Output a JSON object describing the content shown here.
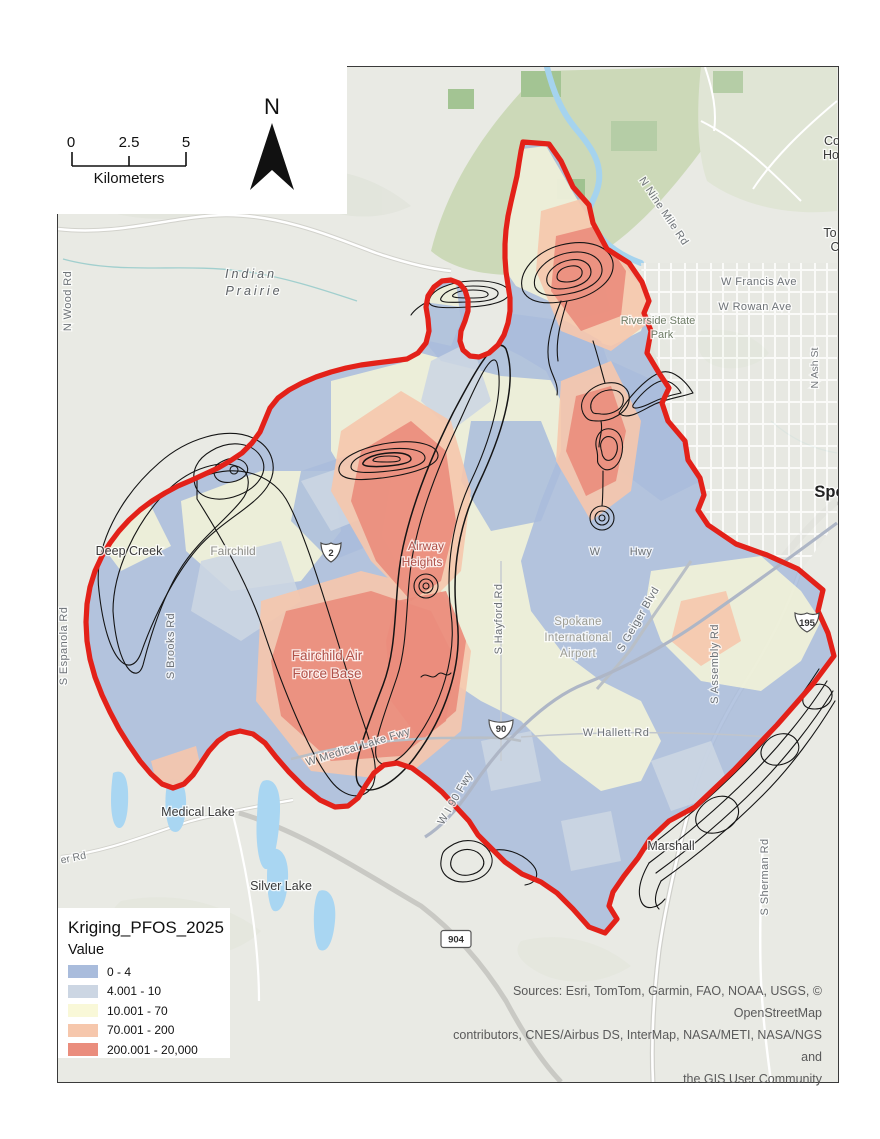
{
  "map": {
    "legend": {
      "title": "Kriging_PFOS_2025",
      "field_label": "Value",
      "items": [
        {
          "label": "0 - 4",
          "color": "#a9bcdc"
        },
        {
          "label": "4.001 - 10",
          "color": "#ccd6e3"
        },
        {
          "label": "10.001 - 70",
          "color": "#f9f8d8"
        },
        {
          "label": "70.001 - 200",
          "color": "#f6c7ac"
        },
        {
          "label": "200.001 - 20,000",
          "color": "#ea8d7d"
        }
      ]
    },
    "scalebar": {
      "ticks": [
        "0",
        "2.5",
        "5"
      ],
      "unit": "Kilometers"
    },
    "north_arrow": {
      "label": "N"
    },
    "attribution": {
      "line1": "Sources: Esri, TomTom, Garmin, FAO, NOAA, USGS, © OpenStreetMap",
      "line2": "contributors, CNES/Airbus DS, InterMap, NASA/METI, NASA/NGS and",
      "line3": "the GIS User Community"
    },
    "colors": {
      "boundary": "#e32119",
      "class1": "#a9bcdc",
      "class2": "#ccd6e3",
      "class3": "#f9f8d8",
      "class4": "#f6c7ac",
      "class5": "#ea8d7d"
    },
    "shields": [
      {
        "name": "us-2",
        "number": "2"
      },
      {
        "name": "i-90",
        "number": "90"
      },
      {
        "name": "us-195",
        "number": "195"
      },
      {
        "name": "sr-904",
        "number": "904"
      }
    ],
    "labels": [
      {
        "name": "label-indian-prairie-1",
        "text": "Indian",
        "x": 250,
        "y": 277,
        "rot": 0,
        "cls": "prairie"
      },
      {
        "name": "label-indian-prairie-2",
        "text": "Prairie",
        "x": 253,
        "y": 294,
        "rot": 0,
        "cls": "prairie"
      },
      {
        "name": "label-n-wood-rd",
        "text": "N Wood Rd",
        "x": 70,
        "y": 300,
        "rot": -90,
        "cls": "road"
      },
      {
        "name": "label-n-nine-mile-rd",
        "text": "N Nine Mile Rd",
        "x": 660,
        "y": 212,
        "rot": 56,
        "cls": "road"
      },
      {
        "name": "label-co",
        "text": "Co",
        "x": 831,
        "y": 144,
        "rot": 0,
        "cls": "town"
      },
      {
        "name": "label-ho",
        "text": "Ho",
        "x": 830,
        "y": 158,
        "rot": 0,
        "cls": "town"
      },
      {
        "name": "label-to",
        "text": "To",
        "x": 829,
        "y": 236,
        "rot": 0,
        "cls": "town"
      },
      {
        "name": "label-c",
        "text": "C",
        "x": 834,
        "y": 250,
        "rot": 0,
        "cls": "town"
      },
      {
        "name": "label-w-francis-ave",
        "text": "W Francis Ave",
        "x": 758,
        "y": 284,
        "rot": 0,
        "cls": "road"
      },
      {
        "name": "label-w-rowan-ave",
        "text": "W Rowan Ave",
        "x": 754,
        "y": 309,
        "rot": 0,
        "cls": "road"
      },
      {
        "name": "label-riverside-1",
        "text": "Riverside State",
        "x": 657,
        "y": 323,
        "rot": 0,
        "cls": "park"
      },
      {
        "name": "label-riverside-2",
        "text": "Park",
        "x": 661,
        "y": 337,
        "rot": 0,
        "cls": "park"
      },
      {
        "name": "label-n-ash-st",
        "text": "N Ash St",
        "x": 817,
        "y": 367,
        "rot": -90,
        "cls": "road-sm"
      },
      {
        "name": "label-spokane-partial",
        "text": "Spo",
        "x": 829,
        "y": 496,
        "rot": 0,
        "cls": "city"
      },
      {
        "name": "label-deep-creek",
        "text": "Deep Creek",
        "x": 128,
        "y": 554,
        "rot": 0,
        "cls": "town"
      },
      {
        "name": "label-fairchild",
        "text": "Fairchild",
        "x": 232,
        "y": 554,
        "rot": 0,
        "cls": "muted-town"
      },
      {
        "name": "label-airway-heights-1",
        "text": "Airway",
        "x": 425,
        "y": 549,
        "rot": 0,
        "cls": "red-town"
      },
      {
        "name": "label-airway-heights-2",
        "text": "Heights",
        "x": 421,
        "y": 565,
        "rot": 0,
        "cls": "red-town"
      },
      {
        "name": "label-w-hwy-w",
        "text": "W",
        "x": 594,
        "y": 554,
        "rot": 0,
        "cls": "road"
      },
      {
        "name": "label-w-hwy-hwy",
        "text": "Hwy",
        "x": 640,
        "y": 554,
        "rot": 0,
        "cls": "road"
      },
      {
        "name": "label-s-brooks-rd",
        "text": "S Brooks Rd",
        "x": 173,
        "y": 645,
        "rot": -90,
        "cls": "road"
      },
      {
        "name": "label-s-espanola-rd",
        "text": "S Espanola Rd",
        "x": 66,
        "y": 645,
        "rot": -90,
        "cls": "road"
      },
      {
        "name": "label-fafb-1",
        "text": "Fairchild Air",
        "x": 326,
        "y": 659,
        "rot": 0,
        "cls": "red-area"
      },
      {
        "name": "label-fafb-2",
        "text": "Force Base",
        "x": 326,
        "y": 677,
        "rot": 0,
        "cls": "red-area"
      },
      {
        "name": "label-s-hayford-rd",
        "text": "S Hayford Rd",
        "x": 501,
        "y": 618,
        "rot": -90,
        "cls": "road"
      },
      {
        "name": "label-airport-1",
        "text": "Spokane",
        "x": 577,
        "y": 624,
        "rot": 0,
        "cls": "muted"
      },
      {
        "name": "label-airport-2",
        "text": "International",
        "x": 577,
        "y": 640,
        "rot": 0,
        "cls": "muted"
      },
      {
        "name": "label-airport-3",
        "text": "Airport",
        "x": 577,
        "y": 656,
        "rot": 0,
        "cls": "muted"
      },
      {
        "name": "label-s-geiger-blvd",
        "text": "S Geiger Blvd",
        "x": 640,
        "y": 620,
        "rot": -60,
        "cls": "road"
      },
      {
        "name": "label-s-assembly-rd",
        "text": "S Assembly Rd",
        "x": 717,
        "y": 663,
        "rot": -90,
        "cls": "road"
      },
      {
        "name": "label-w-hallett-rd",
        "text": "W Hallett Rd",
        "x": 615,
        "y": 735,
        "rot": 0,
        "cls": "road"
      },
      {
        "name": "label-w-medical-lake-fwy",
        "text": "W Medical Lake Fwy",
        "x": 358,
        "y": 749,
        "rot": -17,
        "cls": "road"
      },
      {
        "name": "label-w-i90-fwy",
        "text": "W I 90 Fwy",
        "x": 457,
        "y": 799,
        "rot": -60,
        "cls": "road"
      },
      {
        "name": "label-medical-lake",
        "text": "Medical Lake",
        "x": 197,
        "y": 815,
        "rot": 0,
        "cls": "town"
      },
      {
        "name": "label-er-rd",
        "text": "er Rd",
        "x": 73,
        "y": 860,
        "rot": -12,
        "cls": "road-sm"
      },
      {
        "name": "label-silver-lake",
        "text": "Silver Lake",
        "x": 280,
        "y": 889,
        "rot": 0,
        "cls": "town"
      },
      {
        "name": "label-marshall",
        "text": "Marshall",
        "x": 670,
        "y": 849,
        "rot": 0,
        "cls": "town"
      },
      {
        "name": "label-s-sherman-rd",
        "text": "S Sherman Rd",
        "x": 767,
        "y": 876,
        "rot": -90,
        "cls": "road"
      }
    ]
  }
}
